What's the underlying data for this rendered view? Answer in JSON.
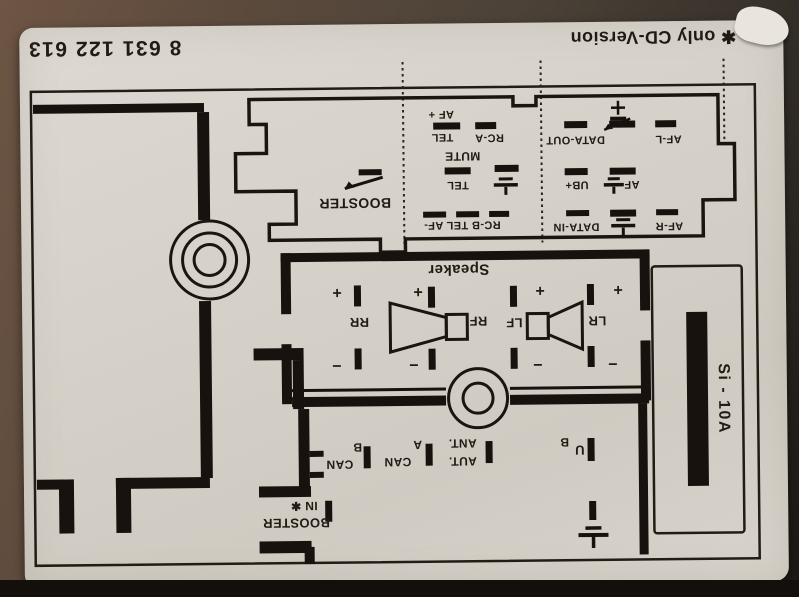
{
  "header": {
    "part_number": "8 631 122 613",
    "version_note": "✱ only CD-Version"
  },
  "upper_connector": {
    "booster": "BOOSTER",
    "af_plus": "AF +",
    "tel": "TEL",
    "rc_a": "RC-A",
    "mute": "MUTE",
    "rcb_tel_af": "RC-B TEL AF-",
    "data_out": "DATA-OUT",
    "af_l": "AF-L",
    "ub_plus": "UB+",
    "af": "AF",
    "data_in": "DATA-IN",
    "af_r": "AF-R"
  },
  "speaker": {
    "title": "Speaker",
    "rr": "RR",
    "rf": "RF",
    "lf": "LF",
    "lr": "LR",
    "plus": "+",
    "minus": "−"
  },
  "lower_connector": {
    "can": "CAN",
    "can_b": "B",
    "can_a": "A",
    "ant": "ANT.",
    "aut": "AUT.",
    "u": "U",
    "ub_b": "B",
    "booster": "BOOSTER",
    "in_star": "IN ✱"
  },
  "fuse": {
    "label": "Si - 10A"
  },
  "icons": {
    "ground": "earth-ground",
    "screw_hole": "concentric-circles",
    "switch": "switch-lever",
    "speaker": "speaker-cone",
    "star": "✱"
  },
  "colors": {
    "paper": "#d6d2ca",
    "ink": "#1c1712",
    "photo_bg": "#4c4238"
  }
}
